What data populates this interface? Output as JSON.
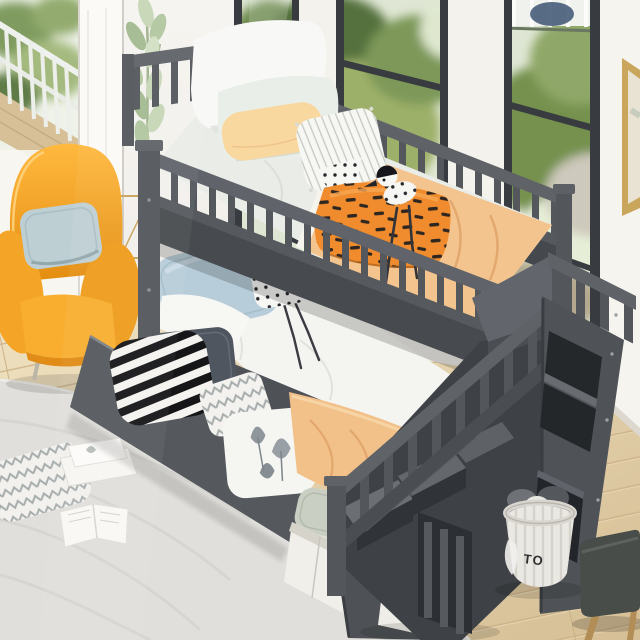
{
  "scene": {
    "title": "Gray twin-over-twin bunk bed with storage staircase, trundle drawers, orange armchair and bright windows",
    "toy_basket": {
      "label": "TO"
    },
    "colors": {
      "bed_frame_gray": "#54585c",
      "bed_frame_dark": "#3f4347",
      "staircase_gray": "#4a4e52",
      "armchair_orange": "#f5a52a",
      "armchair_cushion_blue": "#bccfd5",
      "pillow_peach": "#f8d79f",
      "pillow_orange": "#f08c2d",
      "pillow_blue": "#b8cdda",
      "blanket_apricot": "#f2c38d",
      "mattress_white": "#f4f4f1",
      "window_frame": "#383c40",
      "foliage_green": "#7f9b5f",
      "wall_white": "#f2f0eb",
      "floor_wood": "#e4d2ac",
      "rug_gray": "#e0dfdb",
      "stool_seat": "#484d49",
      "basket_white": "#eae8e3"
    },
    "objects": [
      {
        "id": "bunk-bed",
        "label": "Gray twin-over-twin bunk bed"
      },
      {
        "id": "storage-staircase",
        "label": "Staircase with storage cubbies"
      },
      {
        "id": "trundle-drawer",
        "label": "Under-bed drawer filled with pillows"
      },
      {
        "id": "checkered-drawer",
        "label": "Stair drawer with checkered blanket"
      },
      {
        "id": "armchair",
        "label": "Orange wingback armchair with blue cushion"
      },
      {
        "id": "toy-basket",
        "label": "Fabric toy basket with plush toys"
      },
      {
        "id": "stool",
        "label": "Dark stool with wooden legs"
      },
      {
        "id": "area-rug",
        "label": "Light gray area rug with open books"
      },
      {
        "id": "potted-plant",
        "label": "Tall pale green plant"
      },
      {
        "id": "window",
        "label": "Black-framed windows with garden view"
      },
      {
        "id": "balcony",
        "label": "Balcony with white railing"
      },
      {
        "id": "wall-art",
        "label": "Gold framed wall art"
      }
    ]
  }
}
